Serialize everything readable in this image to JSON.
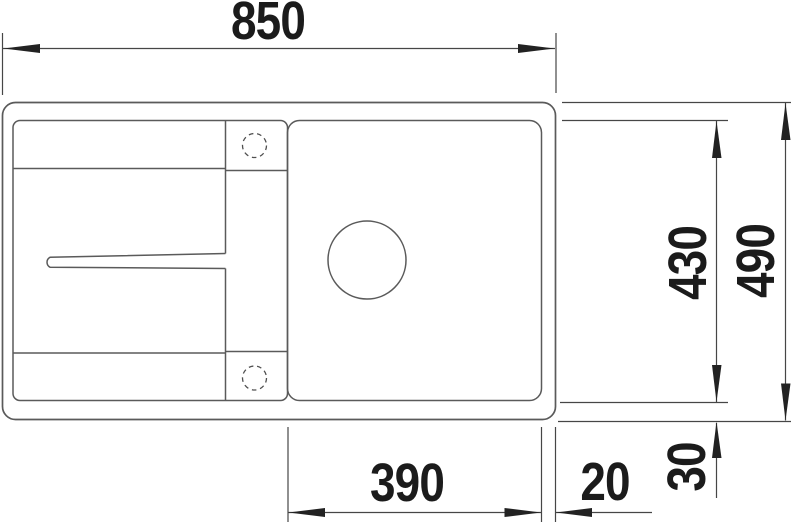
{
  "diagram": {
    "description": "Sink top-view technical dimension drawing",
    "dimensions": {
      "overall_width": "850",
      "inner_depth": "430",
      "overall_depth": "490",
      "bowl_width": "390",
      "rim_right": "20",
      "rim_bottom": "30"
    },
    "colors": {
      "background": "#ffffff",
      "outline": "#5a5a5a",
      "dimension_line": "#464646",
      "text": "#1b1b1b"
    }
  }
}
